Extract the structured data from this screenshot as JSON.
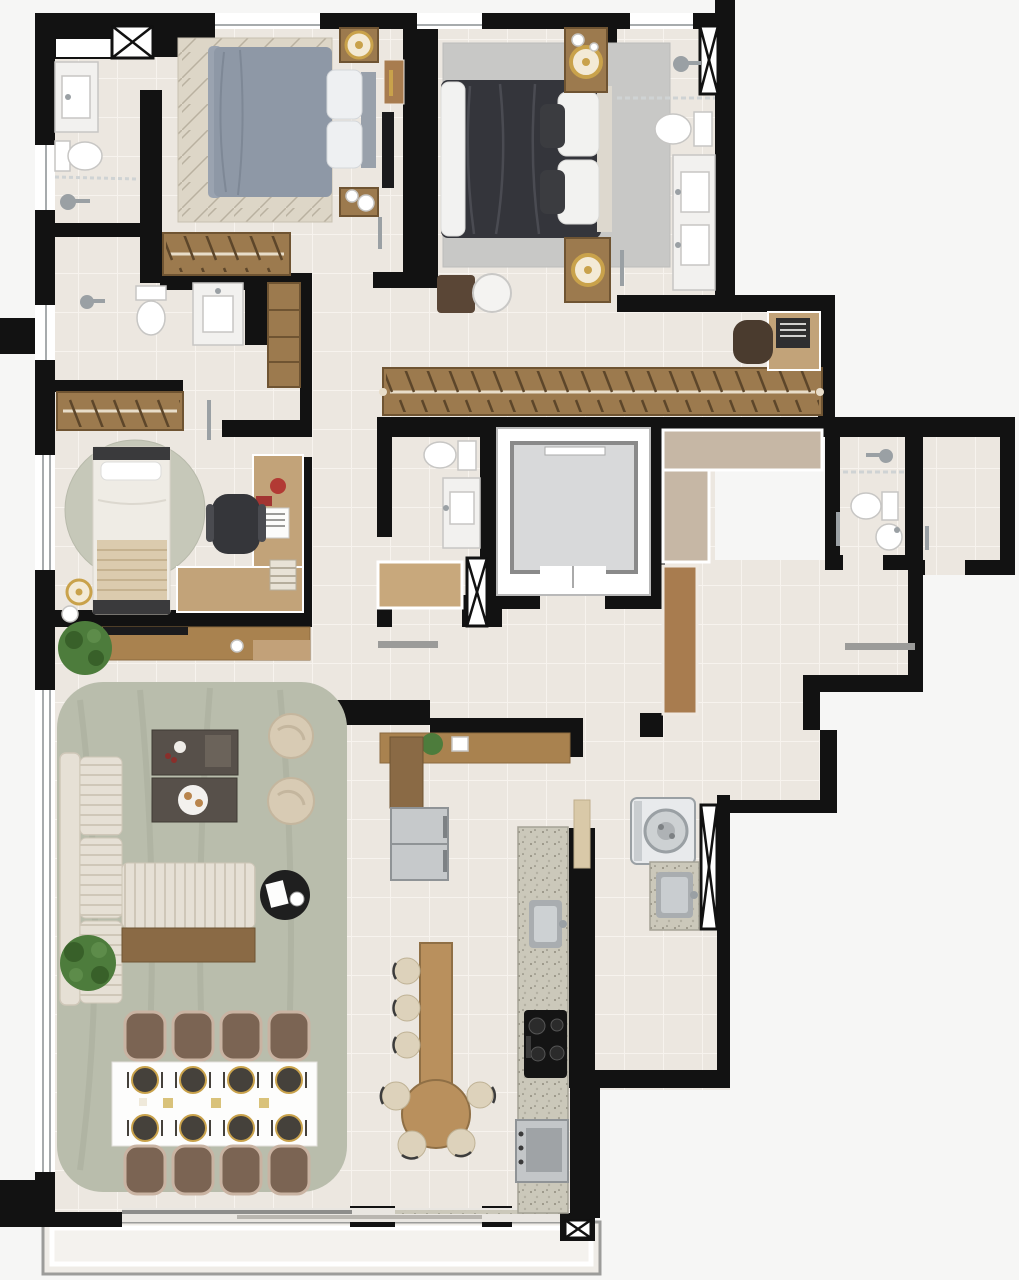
{
  "meta": {
    "kind": "architectural-floor-plan",
    "view": "top-down-render",
    "units": "px",
    "canvas": {
      "w": 1019,
      "h": 1280
    }
  },
  "palette": {
    "bg": "#f6f6f5",
    "wall": "#121212",
    "floor": "#ece7e0",
    "grout": "#f7f3ee",
    "wardrobeWood": "#9c7a4e",
    "wardrobeEdge": "#6f5432",
    "deskWood": "#c2a379",
    "hallWood": "#c6b7a5",
    "doorWood": "#a87c4f",
    "sideboard": "#a9824f",
    "benchWood": "#8a6a45",
    "woodTable": "#b9905d",
    "rugSage": "#b9bdac",
    "rugRound": "#c6c8b9",
    "rugBeige": "#ddd6c7",
    "rugGray": "#c8c8c6",
    "bedGray": "#8e98a6",
    "bedDark": "#34353b",
    "cream": "#ddd8ce",
    "sofaCream": "#e6e0d5",
    "pouf": "#d8cbb4",
    "marble": "#f2f1ef",
    "fixtureEdge": "#c7c6c4",
    "chrome": "#9aa0a4",
    "gold": "#c9a24b",
    "steel": "#b9bcbe",
    "granite": "#cbc8ba",
    "plant": "#4d7c3c",
    "plantDark": "#386029",
    "chairBrown": "#7b6453",
    "chairRim": "#c9b3a2",
    "tableWhite": "#fdfdfc",
    "plateDark": "#45413b",
    "elevCab": "#d8d9da",
    "glass": "#a7abad",
    "red": "#b23a34",
    "stoolBeige": "#ddd2bb",
    "darkTable": "#57504a",
    "washer": "#e8eaec",
    "tv": "#1b1b1d"
  },
  "legend": {
    "rooms": [
      "bathroom-1",
      "bedroom-1",
      "bedroom-2-master",
      "bathroom-master",
      "bathroom-2",
      "bedroom-3",
      "walk-in-closet",
      "office-nook",
      "powder-room",
      "elevator",
      "foyer-hall",
      "bathroom-3",
      "storage-room",
      "service-corridor",
      "living-room",
      "dining-area",
      "kitchen",
      "laundry-area",
      "balcony"
    ],
    "furniture": [
      "double-bed-gray",
      "double-bed-dark",
      "single-bed",
      "sectional-sofa",
      "coffee-table",
      "pouf",
      "side-table",
      "tv-console",
      "sideboard",
      "dining-table-8-seats",
      "dining-chair",
      "bar-table",
      "stool",
      "refrigerator",
      "kitchen-counter",
      "sink",
      "cooktop",
      "oven",
      "washing-machine",
      "laundry-sink",
      "toilet",
      "vanity-sink",
      "shower-head",
      "wardrobe-hangers",
      "desk",
      "office-chair",
      "plant",
      "lamp-gold",
      "elevator-cab",
      "duct-shaft"
    ]
  }
}
